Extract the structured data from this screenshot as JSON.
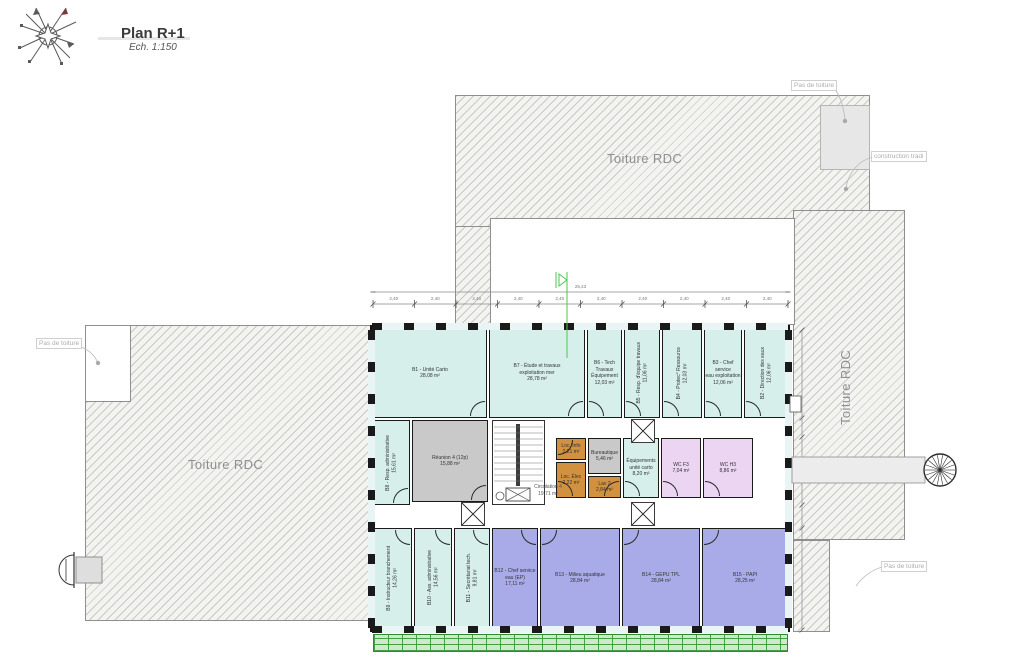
{
  "title_block": {
    "title": "Plan R+1",
    "scale": "Ech. 1:150"
  },
  "annotations": {
    "toiture_top": "Toiture RDC",
    "toiture_left": "Toiture RDC",
    "toiture_right": "Toiture RDC",
    "pas_top": "Pas de toiture",
    "pas_left": "Pas de toiture",
    "pas_bottom": "Pas de toiture",
    "construction": "construction tradi",
    "circulation_name": "Circulation 4",
    "circulation_area": "19,71 m²"
  },
  "dimensions": {
    "total": "25,43",
    "segments": [
      "2,40",
      "2,40",
      "2,40",
      "2,40",
      "2,40",
      "2,40",
      "2,40",
      "2,40",
      "2,40",
      "2,40"
    ]
  },
  "colors": {
    "teal": "#d6efeb",
    "purple": "#a9abe8",
    "pink": "#ebd5f3",
    "orange": "#d2913f",
    "gray": "#c9c9c9",
    "roof_hatch_bg": "#f3f3f0",
    "louver_green": "#44a044",
    "wall": "#1a1a1a",
    "section_line": "#53c653"
  },
  "rooms": [
    {
      "id": "b1",
      "label": [
        "B1 - Unité Carto"
      ],
      "area": "28,08 m²",
      "color": "teal",
      "x": 373,
      "y": 328,
      "w": 114,
      "h": 90,
      "dir": "h",
      "door": "br"
    },
    {
      "id": "b7",
      "label": [
        "B7 - Étude et travaux",
        "exploitation mer"
      ],
      "area": "28,78 m²",
      "color": "teal",
      "x": 489,
      "y": 328,
      "w": 96,
      "h": 90,
      "dir": "h",
      "door": "br"
    },
    {
      "id": "b6",
      "label": [
        "B6 - Tech Travaux",
        "Équipement"
      ],
      "area": "12,03 m²",
      "color": "teal",
      "x": 587,
      "y": 328,
      "w": 35,
      "h": 90,
      "dir": "h",
      "door": "bl"
    },
    {
      "id": "b5",
      "label": [
        "B5 - Resp. d'équipe travaux"
      ],
      "area": "11,06 m²",
      "color": "teal",
      "x": 624,
      "y": 328,
      "w": 36,
      "h": 90,
      "dir": "v",
      "door": "bl"
    },
    {
      "id": "b4",
      "label": [
        "B4 - Protec° Ressource"
      ],
      "area": "12,03 m²",
      "color": "teal",
      "x": 662,
      "y": 328,
      "w": 40,
      "h": 90,
      "dir": "v",
      "door": "bl"
    },
    {
      "id": "b3",
      "label": [
        "B3 - Chef service",
        "eau exploitation"
      ],
      "area": "12,06 m²",
      "color": "teal",
      "x": 704,
      "y": 328,
      "w": 38,
      "h": 90,
      "dir": "h",
      "door": "bl"
    },
    {
      "id": "b2",
      "label": [
        "B2 - Direction des eaux"
      ],
      "area": "12,06 m²",
      "color": "teal",
      "x": 744,
      "y": 328,
      "w": 44,
      "h": 90,
      "dir": "v",
      "door": "bl"
    },
    {
      "id": "b8",
      "label": [
        "B8 - Resp. administrative"
      ],
      "area": "15,61 m²",
      "color": "teal",
      "x": 373,
      "y": 420,
      "w": 37,
      "h": 85,
      "dir": "v",
      "door": "br"
    },
    {
      "id": "reunion4",
      "label": [
        "Réunion 4 (12p)"
      ],
      "area": "15,88 m²",
      "color": "gray",
      "x": 412,
      "y": 420,
      "w": 76,
      "h": 82,
      "dir": "h",
      "door": "br"
    },
    {
      "id": "loc-info",
      "label": [
        "Loc. Info"
      ],
      "area": "2,21 m²",
      "color": "orange",
      "x": 556,
      "y": 438,
      "w": 30,
      "h": 22,
      "dir": "h",
      "door": "tl"
    },
    {
      "id": "bureautique",
      "label": [
        "Bureautique"
      ],
      "area": "5,46 m²",
      "color": "gray",
      "x": 588,
      "y": 438,
      "w": 33,
      "h": 36,
      "dir": "h"
    },
    {
      "id": "loc-elec",
      "label": [
        "Loc. Élec"
      ],
      "area": "2,22 m²",
      "color": "orange",
      "x": 556,
      "y": 462,
      "w": 30,
      "h": 36,
      "dir": "h",
      "door": "bl"
    },
    {
      "id": "lav2",
      "label": [
        "Lav 2"
      ],
      "area": "2,84 m²",
      "color": "orange",
      "x": 588,
      "y": 476,
      "w": 33,
      "h": 22,
      "dir": "h",
      "door": "br"
    },
    {
      "id": "equipements",
      "label": [
        "Équipements",
        "unité carto"
      ],
      "area": "8,20 m²",
      "color": "teal",
      "x": 623,
      "y": 438,
      "w": 36,
      "h": 60,
      "dir": "h",
      "door": "bl"
    },
    {
      "id": "wc-f3",
      "label": [
        "WC F3"
      ],
      "area": "7,04 m²",
      "color": "pink",
      "x": 661,
      "y": 438,
      "w": 40,
      "h": 60,
      "dir": "h",
      "door": "bl"
    },
    {
      "id": "wc-h3",
      "label": [
        "WC H3"
      ],
      "area": "8,86 m²",
      "color": "pink",
      "x": 703,
      "y": 438,
      "w": 50,
      "h": 60,
      "dir": "h",
      "door": "bl"
    },
    {
      "id": "b9",
      "label": [
        "B9 - Instructeur branchement"
      ],
      "area": "14,26 m²",
      "color": "teal",
      "x": 373,
      "y": 528,
      "w": 39,
      "h": 100,
      "dir": "v",
      "door": "tr"
    },
    {
      "id": "b10",
      "label": [
        "B10 - Ass. administrative"
      ],
      "area": "14,56 m²",
      "color": "teal",
      "x": 414,
      "y": 528,
      "w": 38,
      "h": 100,
      "dir": "v",
      "door": "tr"
    },
    {
      "id": "b11",
      "label": [
        "B11 - Secrétariat tech."
      ],
      "area": "9,81 m²",
      "color": "teal",
      "x": 454,
      "y": 528,
      "w": 36,
      "h": 100,
      "dir": "v",
      "door": "tr"
    },
    {
      "id": "b12",
      "label": [
        "B12 - Chef service",
        "eau (EP)"
      ],
      "area": "17,11 m²",
      "color": "purple",
      "x": 492,
      "y": 528,
      "w": 46,
      "h": 100,
      "dir": "h",
      "door": "tr"
    },
    {
      "id": "b13",
      "label": [
        "B13 - Milieu aquatique"
      ],
      "area": "28,84 m²",
      "color": "purple",
      "x": 540,
      "y": 528,
      "w": 80,
      "h": 100,
      "dir": "h",
      "door": "tl"
    },
    {
      "id": "b14",
      "label": [
        "B14 - GEPU TPL"
      ],
      "area": "28,84 m²",
      "color": "purple",
      "x": 622,
      "y": 528,
      "w": 78,
      "h": 100,
      "dir": "h",
      "door": "tl"
    },
    {
      "id": "b15",
      "label": [
        "B15 - PAPI"
      ],
      "area": "28,25 m²",
      "color": "purple",
      "x": 702,
      "y": 528,
      "w": 86,
      "h": 100,
      "dir": "h",
      "door": "tl"
    }
  ]
}
